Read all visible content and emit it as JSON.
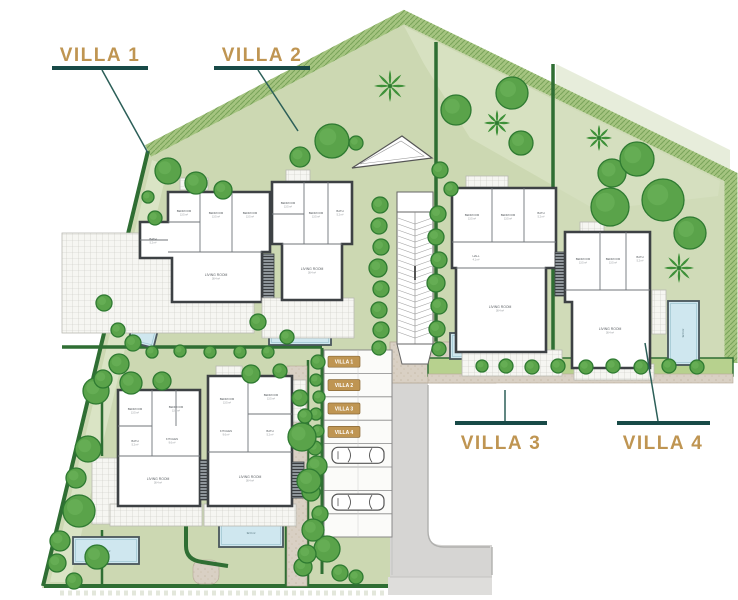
{
  "callouts": {
    "villa1": "VILLA 1",
    "villa2": "VILLA 2",
    "villa3": "VILLA 3",
    "villa4": "VILLA 4"
  },
  "parking": {
    "badges": [
      "VILLA 1",
      "VILLA 2",
      "VILLA 3",
      "VILLA 4"
    ]
  },
  "rooms": {
    "bedroom": "BEDROOM",
    "bathroom": "BATH",
    "kitchen": "KITCHEN",
    "living": "LIVING ROOM",
    "hall": "HALL"
  },
  "areas": {
    "bedroom": "13.5 m²",
    "bathroom": "5.2 m²",
    "kitchen": "9.6 m²",
    "living": "38.4 m²",
    "hall": "4.1 m²",
    "pool": "32.0 m²"
  },
  "colors": {
    "accent_gold": "#bf9552",
    "callout_teal": "#184a47",
    "lawn_green": "#ccd8b2",
    "hedge_green": "#2f6e33",
    "tree_green": "#58a349",
    "pool_blue": "#cfe7ef",
    "road_gray": "#d6d5d3",
    "path_tan": "#d9d0c4"
  }
}
